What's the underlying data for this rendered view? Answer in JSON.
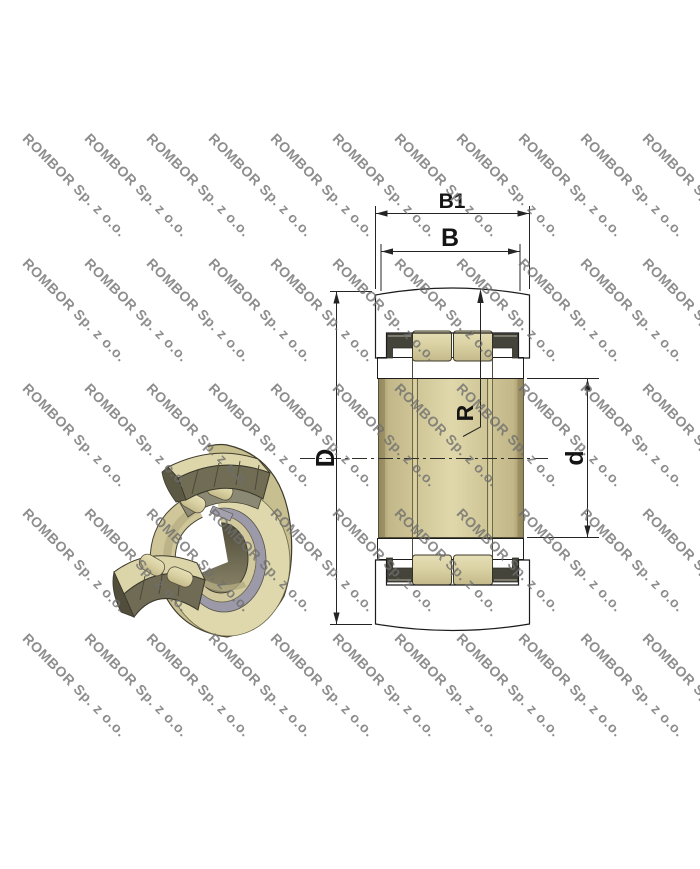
{
  "watermark": {
    "text": "ROMBOR Sp. z o.o."
  },
  "drawing": {
    "type": "bearing cross-section with 3D cutaway view",
    "dimension_labels": {
      "b1": "B1",
      "b": "B",
      "outer_diameter": "D",
      "bore_diameter": "d",
      "crown_radius": "R"
    }
  },
  "colors": {
    "line": "#1c1c1c",
    "dim_line": "#242424",
    "part_fill": "#d7cd9b",
    "hatch_line": "#8a7f52",
    "seal_dark": "#45443a",
    "roller_light": "#e6dfb6",
    "roller_shade": "#c3b98a",
    "gray_ring": "#9c9aa8",
    "bore_light": "#e0d8ab",
    "bore_dark": "#9a8e61",
    "khaki_face": "#ded8ac",
    "khaki_mid": "#c8bf90",
    "cut_dark": "#5b5843",
    "watermark_gray": "#6e6e6e"
  }
}
